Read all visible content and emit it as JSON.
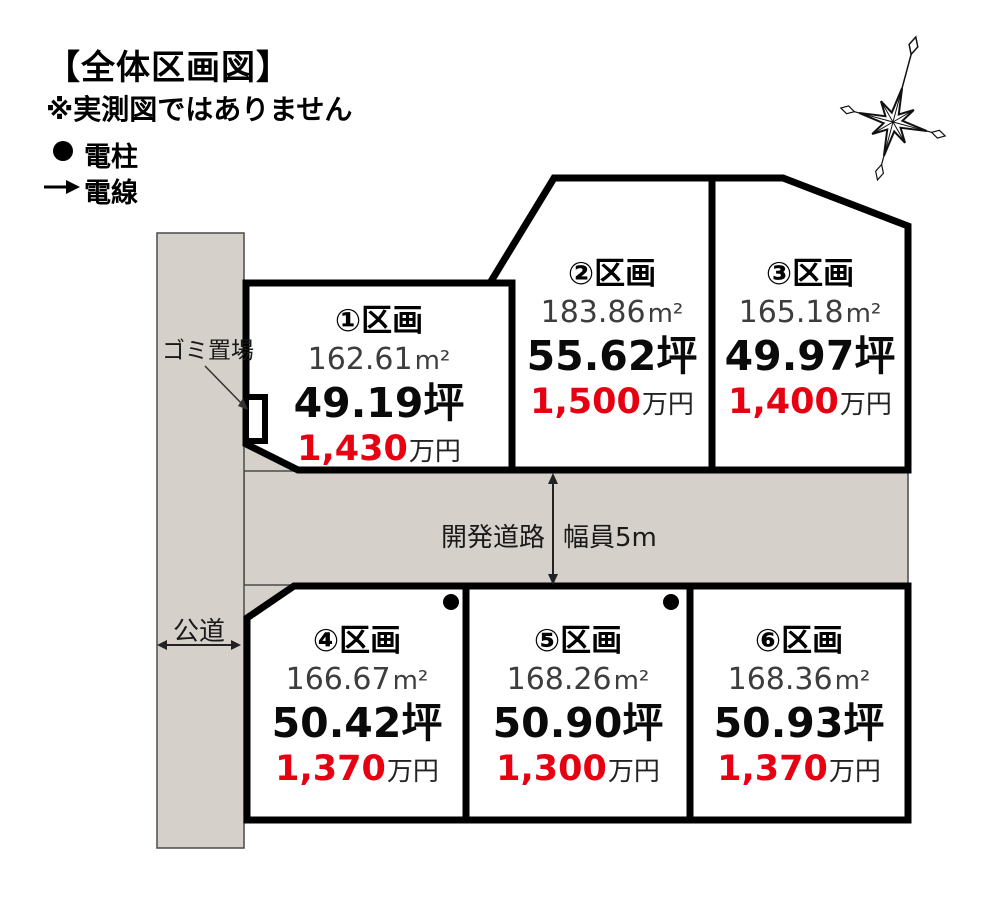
{
  "header": {
    "title": "【全体区画図】",
    "note": "※実測図ではありません",
    "legend": [
      {
        "symbol": "pole-dot",
        "label": "電柱"
      },
      {
        "symbol": "wire-arrow",
        "label": "電線"
      }
    ]
  },
  "map": {
    "roads": {
      "vertical_label": "公道",
      "horizontal_label": "開発道路",
      "width_label": "幅員5m",
      "garbage_label": "ゴミ置場"
    },
    "lots": [
      {
        "id": "①",
        "name": "区画",
        "area_m2": "162.61",
        "area_unit": "m²",
        "tsubo": "49.19",
        "tsubo_unit": "坪",
        "price": "1,430",
        "price_unit": "万円"
      },
      {
        "id": "②",
        "name": "区画",
        "area_m2": "183.86",
        "area_unit": "m²",
        "tsubo": "55.62",
        "tsubo_unit": "坪",
        "price": "1,500",
        "price_unit": "万円"
      },
      {
        "id": "③",
        "name": "区画",
        "area_m2": "165.18",
        "area_unit": "m²",
        "tsubo": "49.97",
        "tsubo_unit": "坪",
        "price": "1,400",
        "price_unit": "万円"
      },
      {
        "id": "④",
        "name": "区画",
        "area_m2": "166.67",
        "area_unit": "m²",
        "tsubo": "50.42",
        "tsubo_unit": "坪",
        "price": "1,370",
        "price_unit": "万円"
      },
      {
        "id": "⑤",
        "name": "区画",
        "area_m2": "168.26",
        "area_unit": "m²",
        "tsubo": "50.90",
        "tsubo_unit": "坪",
        "price": "1,300",
        "price_unit": "万円"
      },
      {
        "id": "⑥",
        "name": "区画",
        "area_m2": "168.36",
        "area_unit": "m²",
        "tsubo": "50.93",
        "tsubo_unit": "坪",
        "price": "1,370",
        "price_unit": "万円"
      }
    ]
  },
  "colors": {
    "road_fill": "#d6d0ca",
    "lot_border": "#000000",
    "price_red": "#e60012",
    "thin_line": "#4a4a4a"
  }
}
